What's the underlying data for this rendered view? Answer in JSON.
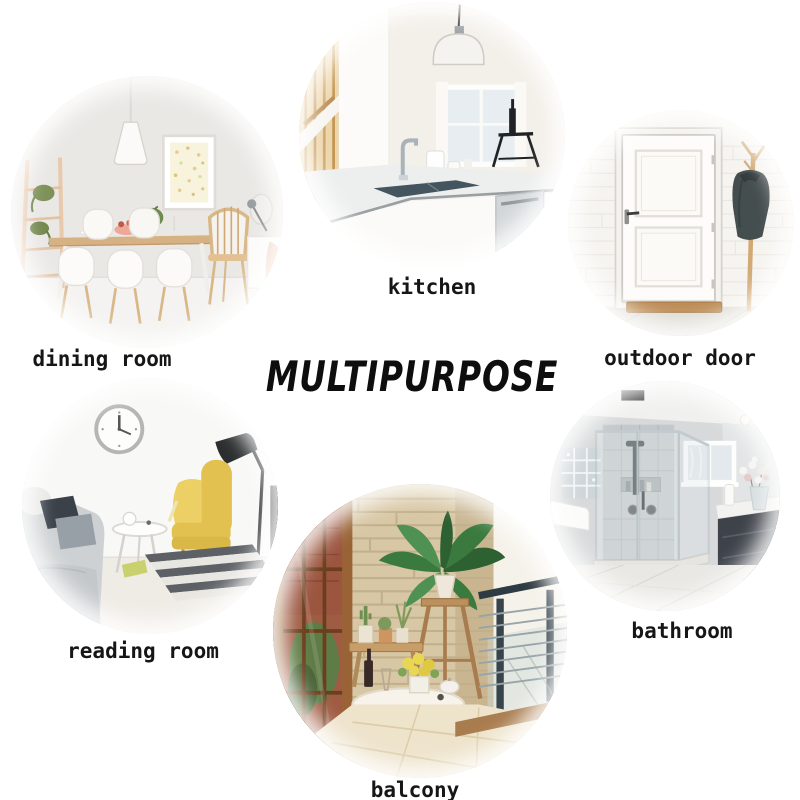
{
  "title": {
    "text": "MULTIPURPOSE",
    "color": "#0e0e0e"
  },
  "rooms": [
    {
      "key": "dining-room",
      "label": "dining room",
      "scene": "white dining room with pendant lamp, ladder shelf, wood table and white chairs"
    },
    {
      "key": "kitchen",
      "label": "kitchen",
      "scene": "white kitchen island with sink, faucet, pendant dome lamp and dishwasher"
    },
    {
      "key": "outdoor-door",
      "label": "outdoor door",
      "scene": "white panel entry door with coat rack, hanging jacket and doormat"
    },
    {
      "key": "reading-room",
      "label": "reading room",
      "scene": "reading corner with wall clock, yellow wingback chair, floor lamp, gray sofa and striped rug"
    },
    {
      "key": "balcony",
      "label": "balcony",
      "scene": "balcony with stone wall, potted plant on stand, round table, stool and cable railing"
    },
    {
      "key": "bathroom",
      "label": "bathroom",
      "scene": "glass shower enclosure, window, dark vanity with flowers"
    }
  ],
  "colors": {
    "background": "#ffffff",
    "label_text": "#161616",
    "title_text": "#0e0e0e",
    "armchair_yellow": "#e3c150",
    "jacket_gray": "#454e4f",
    "wood_tone": "#c79e6a",
    "plant_green": "#3a7a3e",
    "stone_wall": "#d8c7a4"
  }
}
